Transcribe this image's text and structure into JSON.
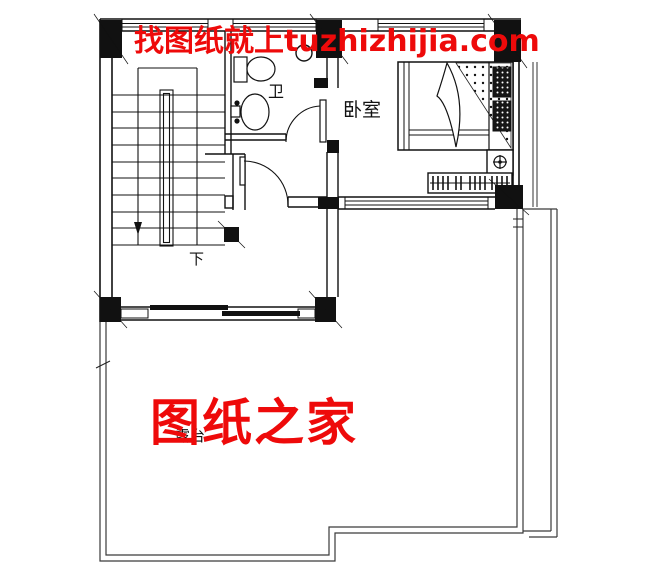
{
  "watermarks": {
    "top_text": "找图纸就上tuzhizhijia.com",
    "center_text": "图纸之家",
    "color": "#ee0a0a"
  },
  "room_labels": {
    "bathroom": "卫",
    "bedroom": "卧室",
    "stair_direction": "下",
    "terrace": "露台"
  },
  "plan": {
    "line_color": "#111111",
    "rail_color": "#3a3a3a",
    "eave_color": "#333333"
  }
}
